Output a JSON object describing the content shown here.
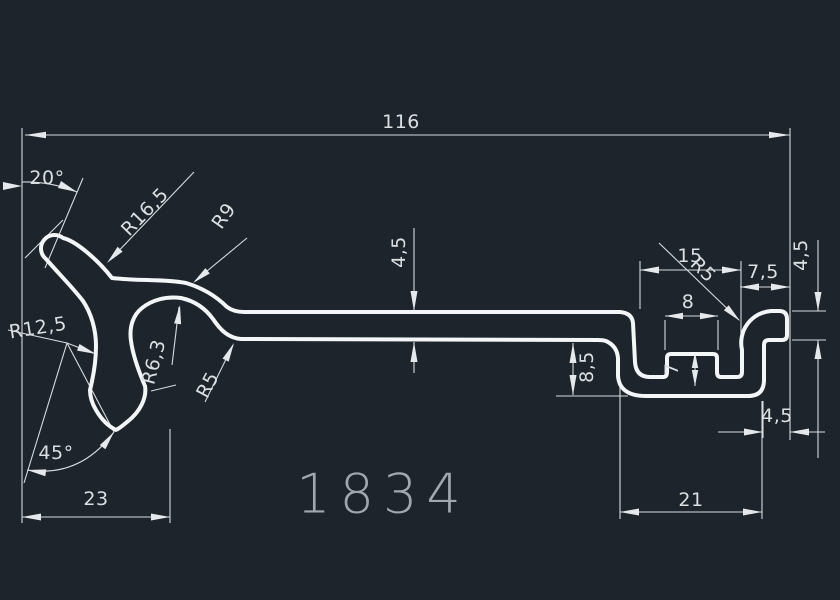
{
  "app": {
    "type": "cad-drawing-viewport",
    "background_color": "#1d242c",
    "profile_line_color": "#f3f5f6",
    "dimension_line_color": "#d7dbdf",
    "dimension_text_color": "#dbdfe2",
    "part_number_color": "#a0a7af"
  },
  "drawing": {
    "part_number": "1834",
    "dims": {
      "total_width": {
        "label": "116"
      },
      "angle_top": {
        "label": "20°"
      },
      "radius_outer_top": {
        "label": "R16,5"
      },
      "radius_neck": {
        "label": "R9"
      },
      "radius_claw": {
        "label": "R12,5"
      },
      "radius_arch": {
        "label": "R6,3"
      },
      "radius_web_left": {
        "label": "R5"
      },
      "web_thickness": {
        "label": "4,5"
      },
      "step_depth": {
        "label": "8,5"
      },
      "slot_width": {
        "label": "15"
      },
      "radius_corner_right": {
        "label": "R5"
      },
      "lip_width": {
        "label": "7,5"
      },
      "lip_thickness": {
        "label": "4,5"
      },
      "tab_width": {
        "label": "8"
      },
      "tab_height": {
        "label": "7"
      },
      "lip_overhang": {
        "label": "4,5"
      },
      "base_width": {
        "label": "21"
      },
      "claw_width": {
        "label": "23"
      },
      "angle_bottom": {
        "label": "45°"
      }
    }
  }
}
